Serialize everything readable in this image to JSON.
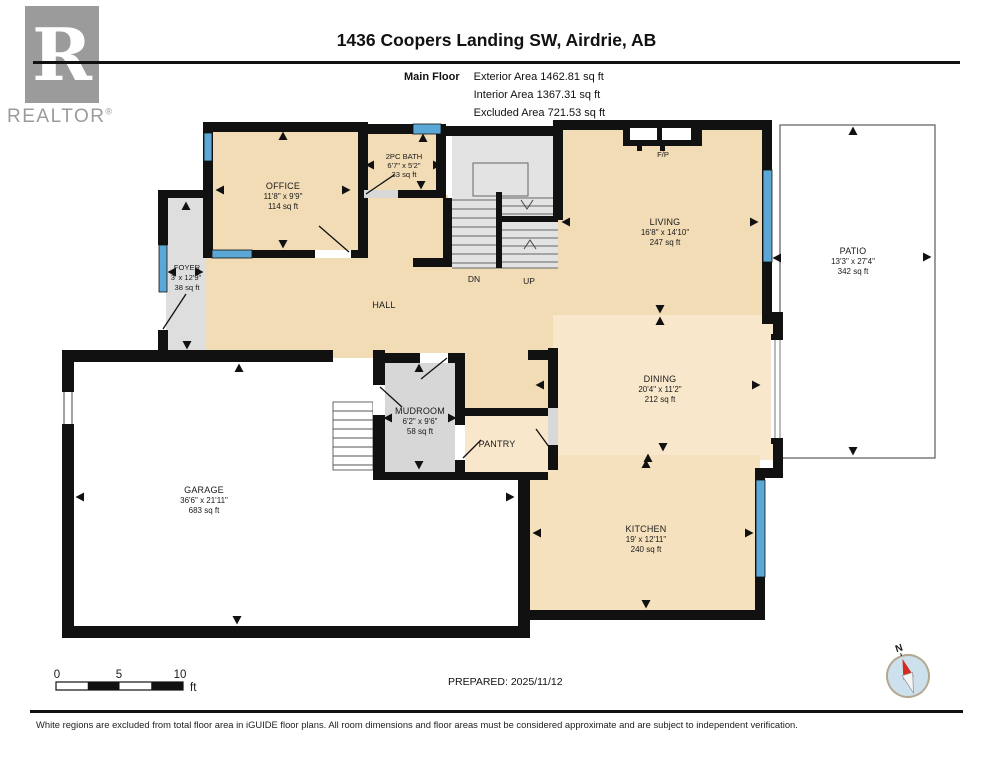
{
  "header": {
    "logo": {
      "letter": "R",
      "brand": "REALTOR",
      "registered": "®"
    },
    "title": "1436 Coopers Landing SW, Airdrie, AB",
    "floor_label": "Main Floor",
    "areas": {
      "exterior": "Exterior Area 1462.81 sq ft",
      "interior": "Interior Area 1367.31 sq ft",
      "excluded": "Excluded Area 721.53 sq ft"
    }
  },
  "rooms": {
    "office": {
      "name": "OFFICE",
      "dims": "11'8\" x 9'9\"",
      "area": "114 sq ft"
    },
    "bath": {
      "name": "2PC BATH",
      "dims": "6'7\" x 5'2\"",
      "area": "33 sq ft"
    },
    "foyer": {
      "name": "FOYER",
      "dims": "3' x 12'9\"",
      "area": "38 sq ft"
    },
    "living": {
      "name": "LIVING",
      "dims": "16'8\" x 14'10\"",
      "area": "247 sq ft"
    },
    "patio": {
      "name": "PATIO",
      "dims": "13'3\" x 27'4\"",
      "area": "342 sq ft"
    },
    "dining": {
      "name": "DINING",
      "dims": "20'4\" x 11'2\"",
      "area": "212 sq ft"
    },
    "kitchen": {
      "name": "KITCHEN",
      "dims": "19' x 12'11\"",
      "area": "240 sq ft"
    },
    "garage": {
      "name": "GARAGE",
      "dims": "36'6\" x 21'11\"",
      "area": "683 sq ft"
    },
    "mudroom": {
      "name": "MUDROOM",
      "dims": "6'2\" x 9'6\"",
      "area": "58 sq ft"
    },
    "pantry": {
      "name": "PANTRY"
    },
    "hall": {
      "name": "HALL"
    },
    "fireplace": {
      "name": "F/P"
    },
    "stairs": {
      "down": "DN",
      "up": "UP"
    }
  },
  "footer": {
    "scale": {
      "t0": "0",
      "t5": "5",
      "t10": "10",
      "unit": "ft"
    },
    "prepared": "PREPARED: 2025/11/12",
    "compass_north": "N",
    "disclaimer": "White regions are excluded from total floor area in iGUIDE floor plans. All room dimensions and floor areas must be considered approximate and are subject to independent verification."
  },
  "colors": {
    "wall": "#111111",
    "window_blue": "#5BA8D6",
    "room_peach": "#F1DCB5",
    "room_light": "#F9E7CC",
    "kitchen_peach": "#F5E1BD",
    "interior_gray": "#D9D9D9",
    "compass_fill": "#CCE1ED",
    "compass_needle": "#D42B1E"
  }
}
